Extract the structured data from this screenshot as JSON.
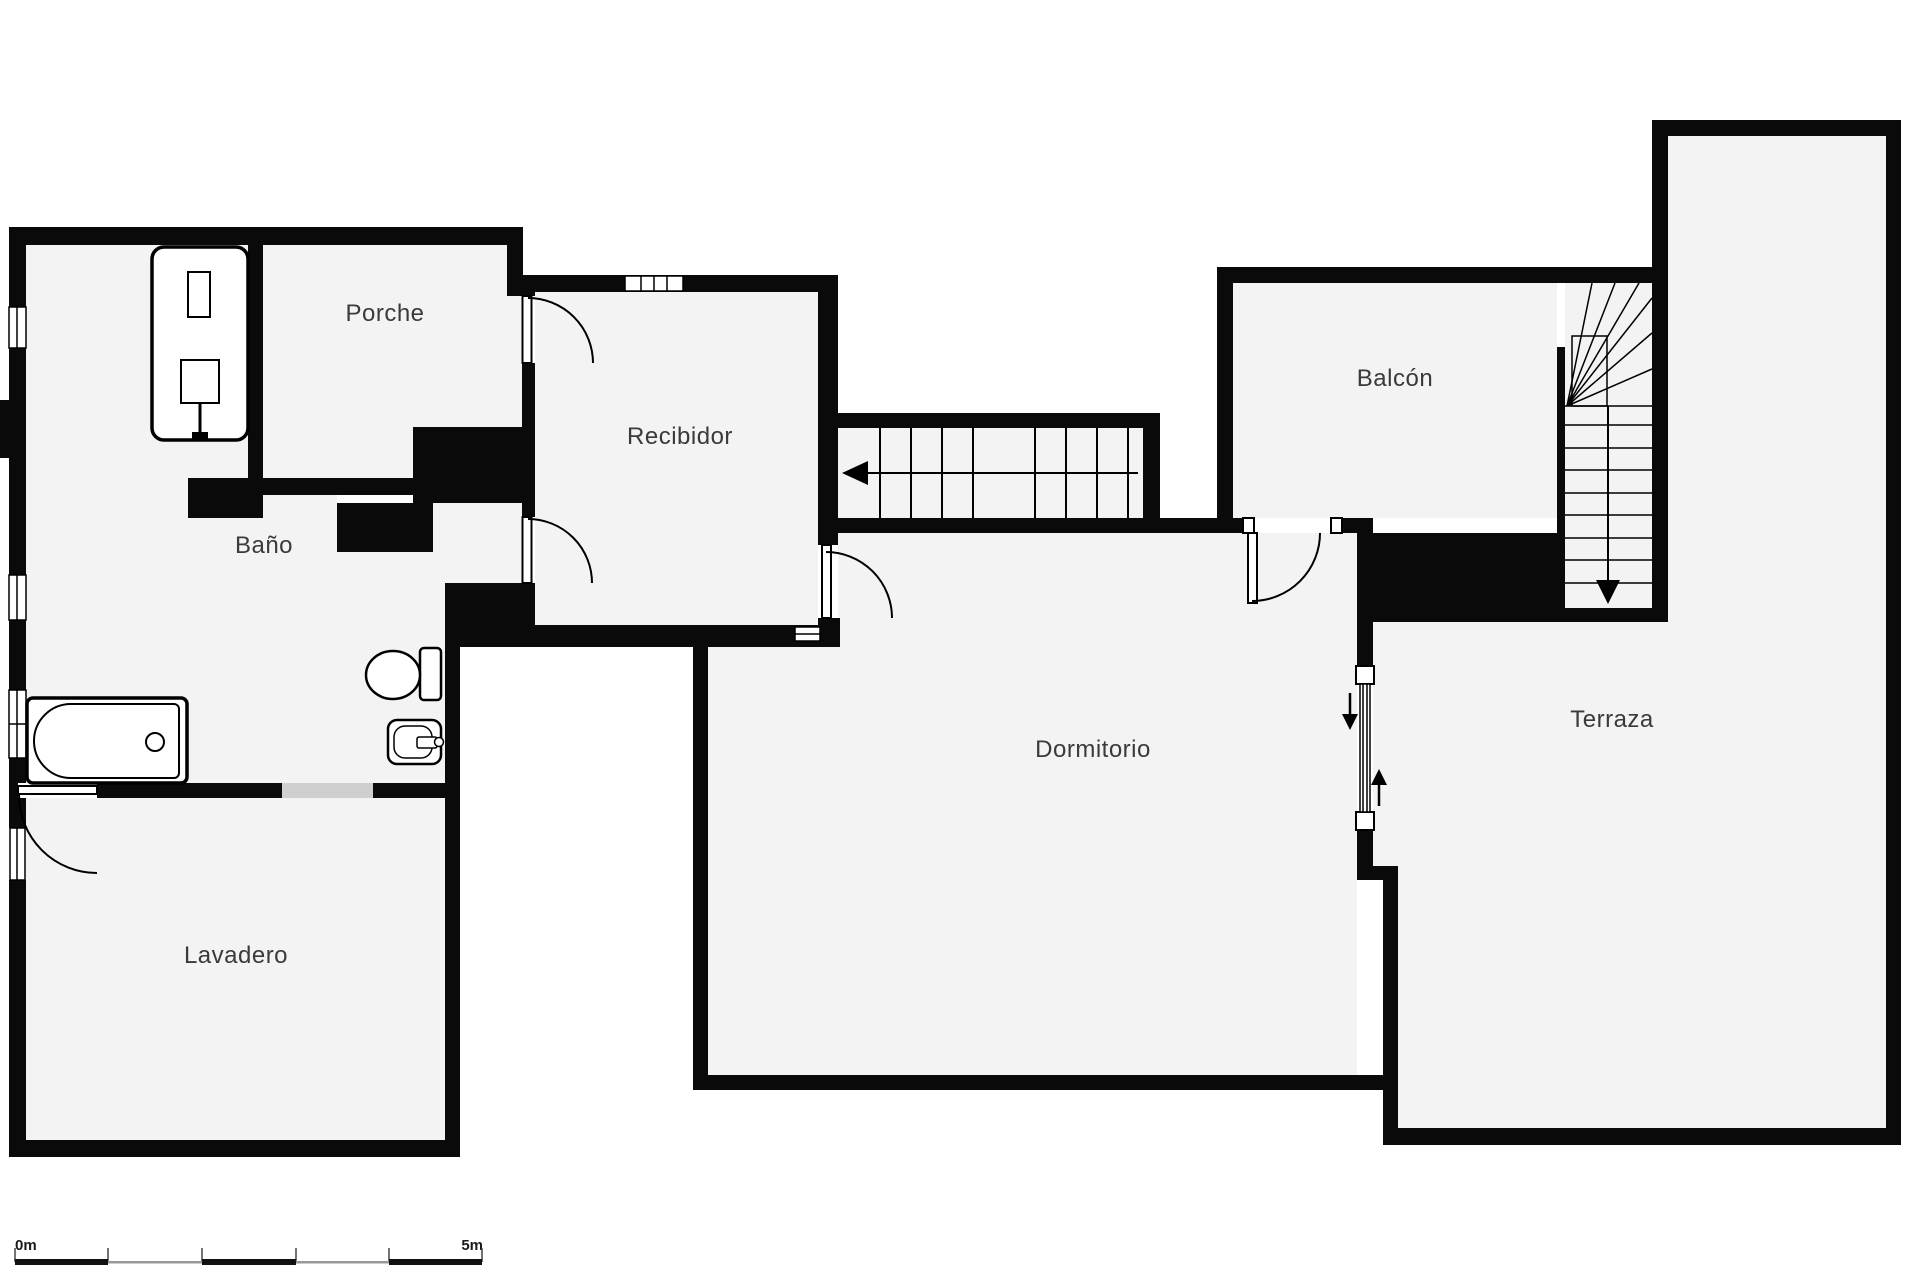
{
  "floorplan": {
    "title": "Floor plan",
    "background_color": "#ffffff",
    "wall_color": "#0a0a0a",
    "room_fill_color": "#f3f3f3",
    "opening_fill_color": "#cfcfcf",
    "label_color": "#3a3a3a",
    "scale_gray": "#999999",
    "rooms": [
      {
        "id": "porche",
        "label": "Porche"
      },
      {
        "id": "bano",
        "label": "Baño"
      },
      {
        "id": "recibidor",
        "label": "Recibidor"
      },
      {
        "id": "lavadero",
        "label": "Lavadero"
      },
      {
        "id": "dormitorio",
        "label": "Dormitorio"
      },
      {
        "id": "balcon",
        "label": "Balcón"
      },
      {
        "id": "terraza",
        "label": "Terraza"
      }
    ],
    "fixtures": [
      "shower",
      "bathtub",
      "toilet",
      "sink"
    ],
    "stairs": [
      {
        "id": "main-stairs",
        "direction_arrow": "left"
      },
      {
        "id": "winder-stairs",
        "direction_arrow": "down"
      }
    ],
    "level_change_arrows": [
      "down",
      "up"
    ],
    "scale_bar": {
      "start_label": "0m",
      "end_label": "5m"
    }
  }
}
